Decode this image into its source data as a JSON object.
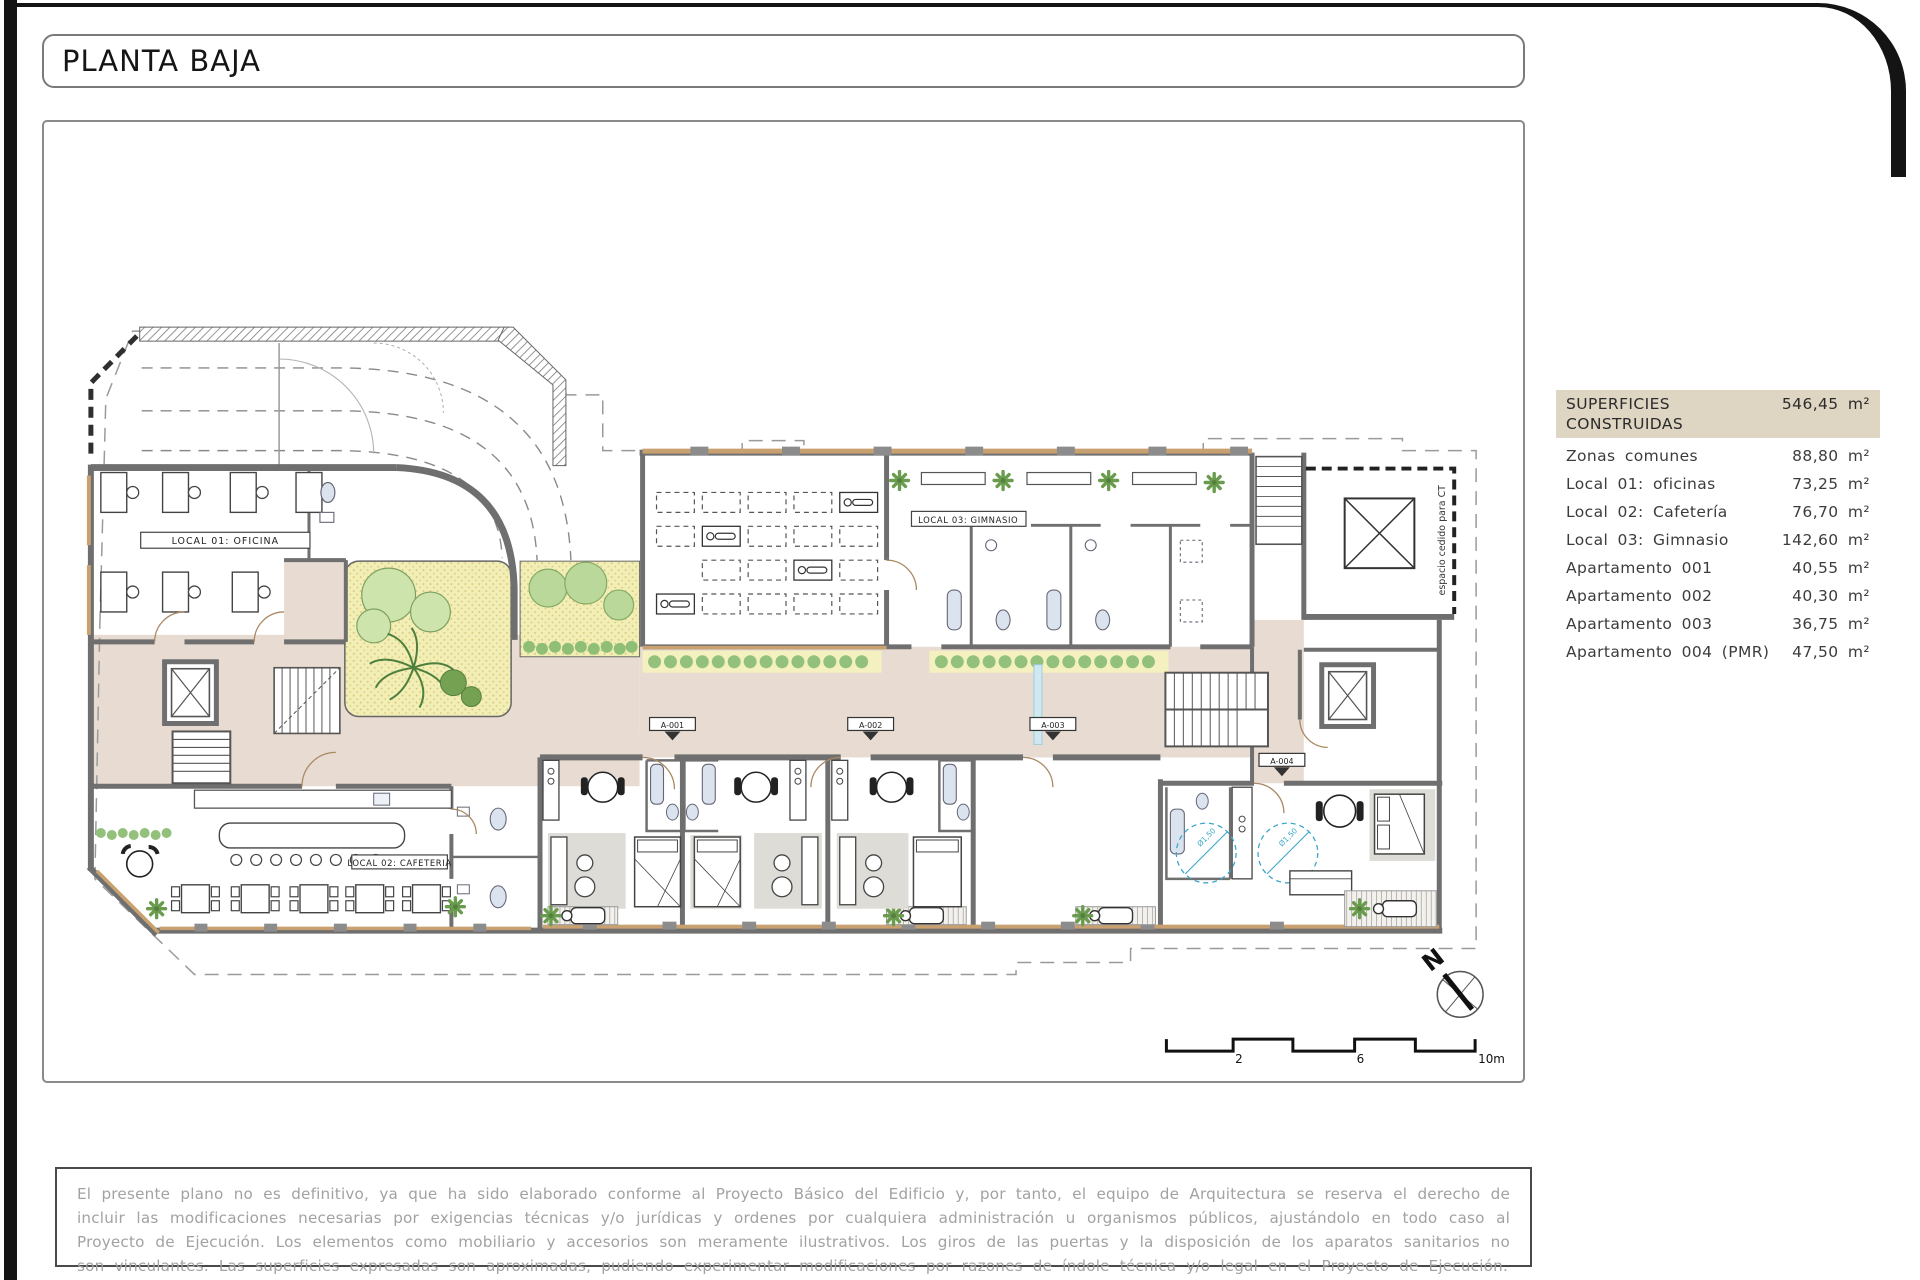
{
  "page": {
    "title": "PLANTA BAJA"
  },
  "legend": {
    "header": {
      "label": "SUPERFICIES CONSTRUIDAS",
      "area": "546,45 m²"
    },
    "items": [
      {
        "label": "Zonas comunes",
        "area": "88,80 m²"
      },
      {
        "label": "Local 01:  oficinas",
        "area": "73,25 m²"
      },
      {
        "label": "Local 02:  Cafetería",
        "area": "76,70 m²"
      },
      {
        "label": "Local 03:  Gimnasio",
        "area": "142,60 m²"
      },
      {
        "label": "Apartamento 001",
        "area": "40,55 m²"
      },
      {
        "label": "Apartamento 002",
        "area": "40,30 m²"
      },
      {
        "label": "Apartamento 003",
        "area": "36,75 m²"
      },
      {
        "label": "Apartamento 004 (PMR)",
        "area": "47,50 m²"
      }
    ]
  },
  "plan": {
    "local01": "LOCAL 01:  OFICINA",
    "local02": "LOCAL 02:  CAFETERIA",
    "local03": "LOCAL 03: GIMNASIO",
    "apt1": "A-001",
    "apt2": "A-002",
    "apt3": "A-003",
    "apt4": "A-004",
    "ct": "espacio cedido para CT",
    "pmr_radius": "Ø1,50",
    "north": "N",
    "scale": {
      "t2": "2",
      "t6": "6",
      "t10": "10m"
    }
  },
  "disclaimer": {
    "text": "El presente plano no es definitivo, ya que ha sido elaborado conforme al Proyecto Básico del Edificio y, por tanto, el equipo de Arquitectura se reserva el derecho de incluir las modificaciones necesarias por exigencias técnicas y/o jurídicas y ordenes por cualquiera administración u organismos públicos, ajustándolo en todo caso al Proyecto de Ejecución. Los elementos como mobiliario y accesorios son meramente ilustrativos. Los giros de las puertas y la disposición de los aparatos sanitarios no son vinculantes. Las superficies expresadas son aproximadas, pudiendo experimentar modificaciones por razones de índole técnica y/o legal en el Proyecto de Ejecución."
  },
  "colors": {
    "wall": "#6f6f6f",
    "corridor_floor": "#e8dcd2",
    "garden": "#f1eeb6",
    "tree_green": "#8fbe77",
    "window_tan": "#c9a171",
    "accessibility_blue": "#3aa7c9",
    "legend_header_bg": "#ded5c2"
  }
}
